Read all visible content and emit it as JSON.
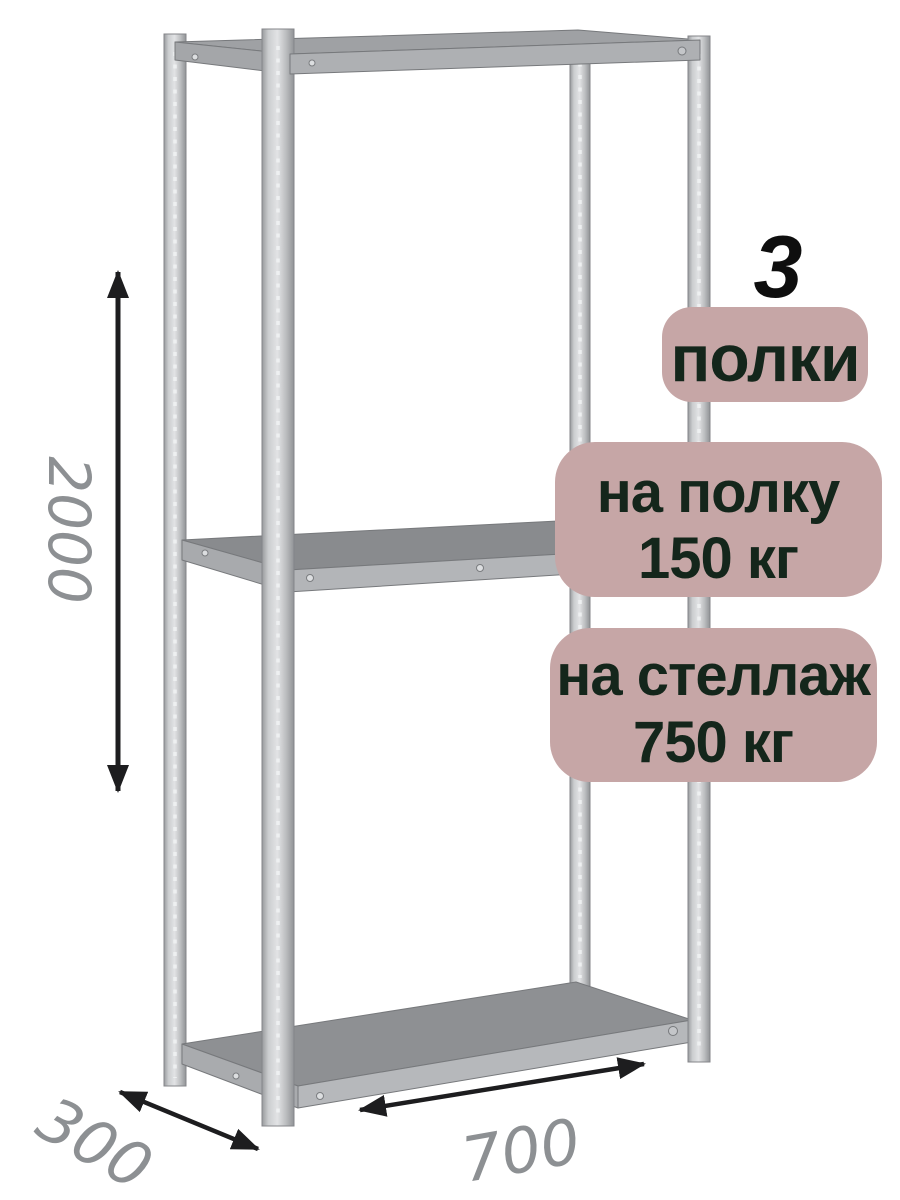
{
  "badges": {
    "bg_color": "#c6a6a6",
    "text_color": "#14261b",
    "shelf_count": {
      "number": "3",
      "label": "полки"
    },
    "shelf_load": {
      "line1": "на полку",
      "line2": "150 кг"
    },
    "rack_load": {
      "line1": "на стеллаж",
      "line2": "750 кг"
    }
  },
  "dimensions": {
    "height_mm": "2000",
    "depth_mm": "300",
    "width_mm": "700",
    "label_color": "#8d9093",
    "arrow_color": "#1d1d1f"
  },
  "rack": {
    "shelves_visible": 3,
    "posts_visible": 4,
    "frame_light": "#d6d8da",
    "frame_dark": "#8e9093"
  }
}
